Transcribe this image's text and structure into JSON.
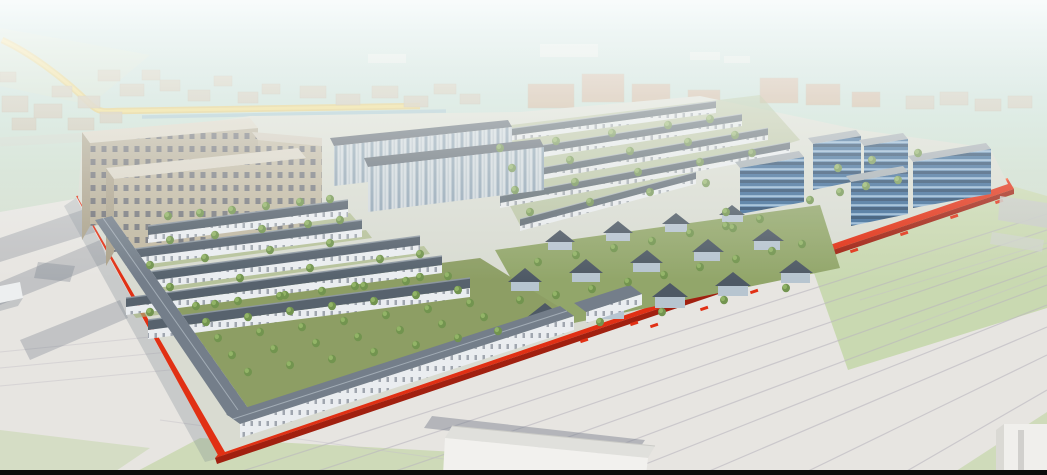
{
  "scene": {
    "title": "Aerial 3D master-plan rendering of a mixed-use development site outlined in red",
    "description": "Perspective bird's-eye rendering: a parallelogram development site bounded by an extruded bright-red band, containing tan apartment slabs, white townhouse rows with dark pitched roofs, detached villas, five blue glass office blocks, two-storey commercial rows and a tree-planted orchard courtyard; hazy low-rise city context behind, railway yard and warehouses in the foreground. No text or UI controls are visible.",
    "view": "aerial-perspective",
    "boundary": {
      "style": "extruded red band with short dashed red offset marks",
      "edges_visible": [
        "west",
        "southeast"
      ],
      "corners_visible": 3
    },
    "regions": [
      {
        "id": "apartment-blocks",
        "label": "tan 8-9 storey apartment slabs with window grid",
        "count": 3,
        "position": "north-west"
      },
      {
        "id": "midrise-slabs",
        "label": "light grey-blue mid-rise housing slabs",
        "count": 2,
        "position": "north-centre"
      },
      {
        "id": "townhouse-rows-west",
        "label": "white townhouse rows, dark grey pitched roofs",
        "rows": 5,
        "position": "west-centre"
      },
      {
        "id": "townhouse-rows-north",
        "label": "townhouse rows receding into haze",
        "rows": 5,
        "position": "north-east"
      },
      {
        "id": "villas",
        "label": "detached villas with pyramidal dark roofs in green yards",
        "count": 14,
        "position": "centre-east"
      },
      {
        "id": "offices",
        "label": "blue glass office buildings with horizontal banding",
        "count": 5,
        "position": "east"
      },
      {
        "id": "commercial-rows",
        "label": "long two-storey commercial rows hugging the boundary",
        "count": 3,
        "position": "south-west"
      },
      {
        "id": "orchard",
        "label": "courtyard orchard planted with a grid of small trees",
        "position": "south-west-interior"
      }
    ],
    "context": {
      "label": "hazy low-rise city blocks, yellow road and canal at upper left, faded orange blocks at top centre"
    },
    "foreground": {
      "label": "light grey railway yard with converging tracks, white warehouse bottom centre, green fields right, black strip along bottom edge"
    }
  },
  "palette": {
    "sky_top": "#add4d4",
    "sky_horizon": "#d3dfce",
    "yard_gray": "#e6e4e0",
    "grass": "#c7d7ad",
    "boundary_red": "#e02508",
    "boundary_red_bright": "#ff3c14",
    "boundary_red_dark": "#9c1504",
    "tan_wall": "#bdb49c",
    "tan_wall_shaded": "#a79d85",
    "tan_roof": "#d8d2c2",
    "townhouse_wall": "#e9edf0",
    "townhouse_roof": "#4e5a66",
    "midrise_roof": "#59636d",
    "villa_roof": "#45515d",
    "villa_wall": "#b4c2ce",
    "office_blue": "#2f6090",
    "office_blue_dark": "#1c3f63",
    "office_glass": "#8fb3d2",
    "office_roof": "#9fa8ae",
    "commercial_roof": "#6d7884",
    "tree_green": "#6b8f46",
    "tree_green_light": "#8db05f",
    "orchard_green": "#87995c",
    "courtyard_green": "#9fb077",
    "road_yellow": "#e3bf52",
    "canal_blue": "#93bac8",
    "track_gray": "#b6b2ba",
    "warehouse_white": "#f2f1ee",
    "context_tan": "#c6bca6",
    "context_orange": "#c9a284",
    "shadow": "rgba(110,118,132,0.32)",
    "frame_black": "#0b0b0b"
  }
}
